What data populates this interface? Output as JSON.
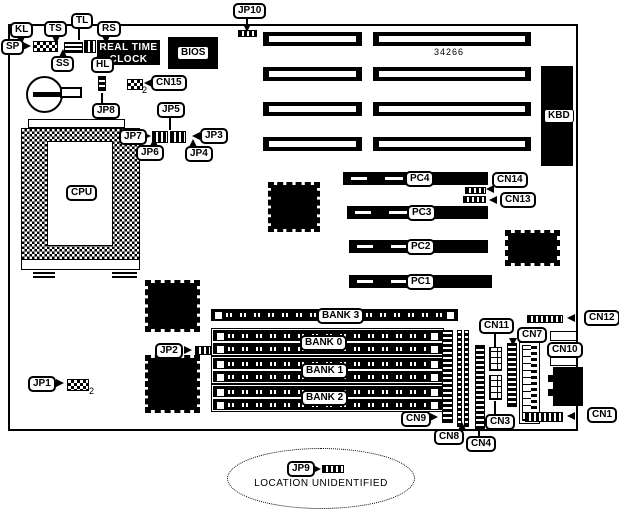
{
  "chips": {
    "rtc_line1": "REAL TIME",
    "rtc_line2": "CLOCK",
    "bios": "BIOS",
    "cpu": "CPU",
    "kbd": "KBD",
    "part_number": "34266"
  },
  "switch_labels": {
    "kl": "KL",
    "ts": "TS",
    "tl": "TL",
    "rs": "RS",
    "sp": "SP",
    "ss": "SS",
    "hl": "HL"
  },
  "jumpers": {
    "jp1": "JP1",
    "jp2": "JP2",
    "jp3": "JP3",
    "jp4": "JP4",
    "jp5": "JP5",
    "jp6": "JP6",
    "jp7": "JP7",
    "jp8": "JP8",
    "jp9": "JP9",
    "jp10": "JP10"
  },
  "connectors": {
    "cn1": "CN1",
    "cn3": "CN3",
    "cn4": "CN4",
    "cn7": "CN7",
    "cn8": "CN8",
    "cn9": "CN9",
    "cn10": "CN10",
    "cn11": "CN11",
    "cn12": "CN12",
    "cn13": "CN13",
    "cn14": "CN14",
    "cn15": "CN15"
  },
  "slots": {
    "pc1": "PC1",
    "pc2": "PC2",
    "pc3": "PC3",
    "pc4": "PC4"
  },
  "memory_banks": {
    "bank0": "BANK 0",
    "bank1": "BANK 1",
    "bank2": "BANK 2",
    "bank3": "BANK 3"
  },
  "annotations": {
    "location_note": "LOCATION UNIDENTIFIED",
    "cn15_pin": "2",
    "jp1_pin": "2"
  }
}
